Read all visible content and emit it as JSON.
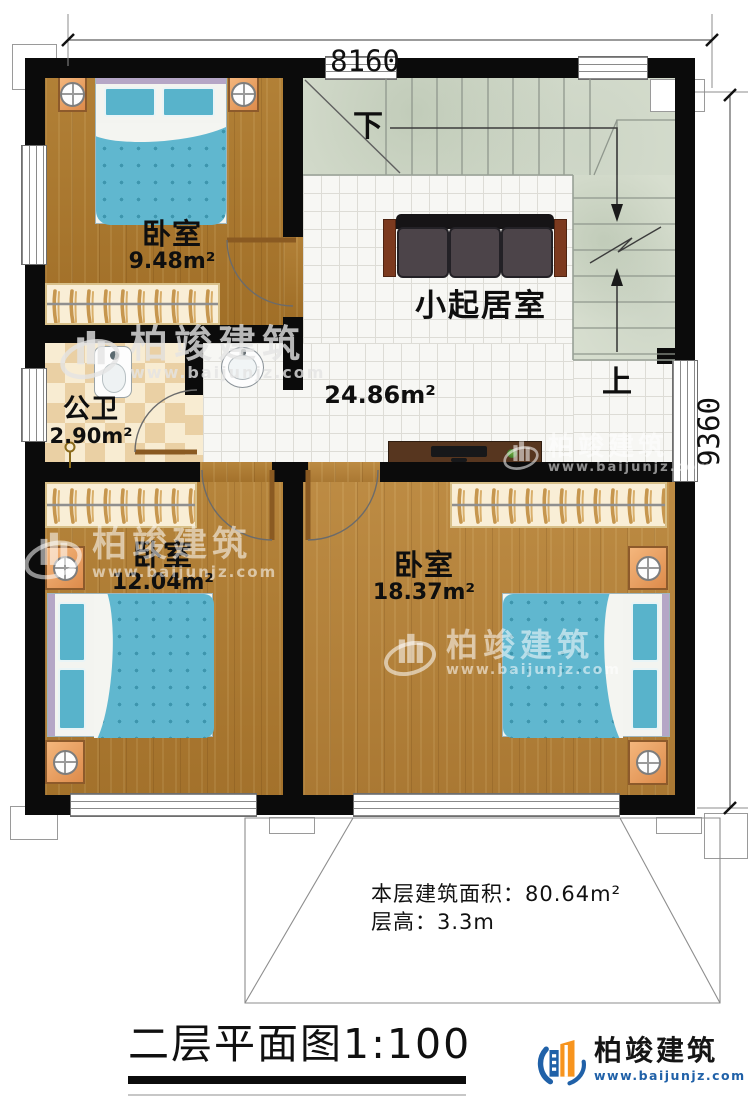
{
  "plan": {
    "dimensions": {
      "width_mm": "8160",
      "height_mm": "9360"
    },
    "rooms": [
      {
        "key": "bedroom_top",
        "name": "卧室",
        "area": "9.48m²"
      },
      {
        "key": "bathroom",
        "name": "公卫",
        "area": "2.90m²"
      },
      {
        "key": "living",
        "name": "小起居室",
        "area": "24.86m²"
      },
      {
        "key": "bedroom_left",
        "name": "卧室",
        "area": "12.04m²"
      },
      {
        "key": "bedroom_right",
        "name": "卧室",
        "area": "18.37m²"
      }
    ],
    "stairs": {
      "down": "下",
      "up": "上"
    },
    "notes": {
      "area": "本层建筑面积：80.64m²",
      "height": "层高：3.3m"
    }
  },
  "title": "二层平面图1:100",
  "brand": {
    "name": "柏竣建筑",
    "site": "www.baijunjz.com",
    "blue": "#2061a8",
    "orange": "#f7941e"
  },
  "watermark": {
    "name": "柏竣建筑",
    "site": "www.baijunjz.com"
  },
  "icons": {
    "lamp": "bedside-lamp (circle with cross)",
    "toilet": "squat-toilet",
    "sink": "wash-basin",
    "monitor": "desktop-monitor",
    "hanger": "clothes-hanger rail",
    "stair_arrow": "stair direction arrow"
  }
}
